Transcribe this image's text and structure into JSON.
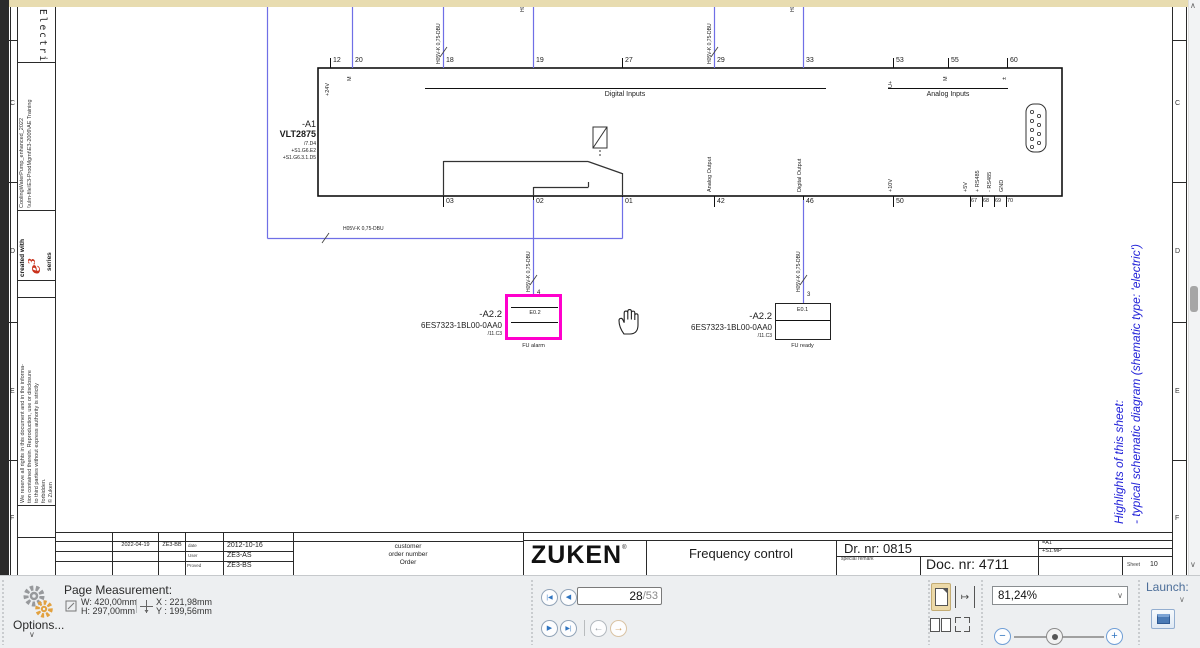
{
  "colors": {
    "highlight_magenta": "#ff00cc",
    "wire_blue": "#6f6fe6",
    "note_blue": "#2424d8",
    "logo_red": "#c9311b",
    "workspace_tan": "#e8dcb0"
  },
  "icons": {
    "chevron_down": "∨",
    "scroll_up": "∧",
    "scroll_down": "∨",
    "nav_first": "|◀",
    "nav_prev": "◀",
    "nav_next": "▶",
    "nav_last": "▶|",
    "back_arrow": "←",
    "forward_arrow": "→",
    "minus": "−",
    "plus": "+",
    "fit_width": "↦",
    "registered": "®"
  },
  "sheet": {
    "row_letters": [
      "C",
      "D",
      "E",
      "F"
    ],
    "margin": {
      "doc_type_vertical": "Electric",
      "created_with": "created with",
      "logo_e": "e",
      "logo_sup": "3",
      "logo_series": "series",
      "project_line1": "CoolingWaterPump_enhanced_2022",
      "project_line2": "\\\\ulm-file\\E3-ProdMgmt\\E3-2009\\AE Training",
      "copyright": "We reserve all rights in this document and in the informa-\ntion contained therein. Reproduction, use or disclosure\nto third parties without express authority is strictly\nforbidden.\n© Zuken"
    },
    "highlights": {
      "line1": "Highlights of this sheet:",
      "line2": "- typical schematic diagram (shematic type: 'electric')"
    }
  },
  "schematic": {
    "wire_label": "H05V-K 0,75-DBU",
    "device": {
      "ref": "-A1",
      "type": "VLT2875",
      "xref": "/7.D4",
      "loc1": "+S1.G6.E2",
      "loc2": "+S1.G6.3.1.D5"
    },
    "top_terminals": [
      "12",
      "20",
      "18",
      "19",
      "27",
      "29",
      "33",
      "53",
      "55",
      "60"
    ],
    "top_pins": [
      "+24V",
      "M",
      "U+",
      "M",
      "±"
    ],
    "group_digital": "Digital Inputs",
    "group_analog": "Analog Inputs",
    "bottom_terminals": [
      "03",
      "02",
      "01",
      "42",
      "46",
      "50",
      "67",
      "68",
      "69",
      "70"
    ],
    "bottom_pins": [
      "Analog Output",
      "Digital Output",
      "+10V",
      "+5V",
      "+ RS485",
      "- RS485",
      "GND"
    ],
    "plc_alarm": {
      "ref": "-A2.2",
      "part": "6ES7323-1BL00-0AA0",
      "xref": "/11.C3",
      "address": "E0.2",
      "pin": "4",
      "function": "FU alarm"
    },
    "plc_ready": {
      "ref": "-A2.2",
      "part": "6ES7323-1BL00-0AA0",
      "xref": "/11.C3",
      "address": "E0.1",
      "pin": "3",
      "function": "FU ready"
    }
  },
  "title_block": {
    "rev_date": "2022-04-19",
    "rev_by": "ZE3-BB",
    "date_label": "date",
    "date_value": "2012-10-16",
    "user_label": "User",
    "user_value": "ZE3-AS",
    "proved_label": "Proved",
    "proved_value": "ZE3-BS",
    "customer_line1": "customer",
    "customer_line2": "order number",
    "customer_line3": "Order",
    "company": "ZUKEN",
    "title": "Frequency control",
    "drawing_number": "Dr. nr: 0815",
    "special_remark_label": "special remark",
    "document_number": "Doc. nr: 4711",
    "plant": "=A1",
    "location": "+S1.MP",
    "sheet_label": "Sheet",
    "sheet_value": "10"
  },
  "toolbar": {
    "page_measurement_label": "Page Measurement:",
    "width": "W: 420,00mm",
    "height": "H: 297,00mm",
    "x": "X : 221,98mm",
    "y": "Y : 199,56mm",
    "options_label": "Options...",
    "page_current": "28",
    "page_total": "/53",
    "zoom_value": "81,24%",
    "launch_label": "Launch:"
  }
}
